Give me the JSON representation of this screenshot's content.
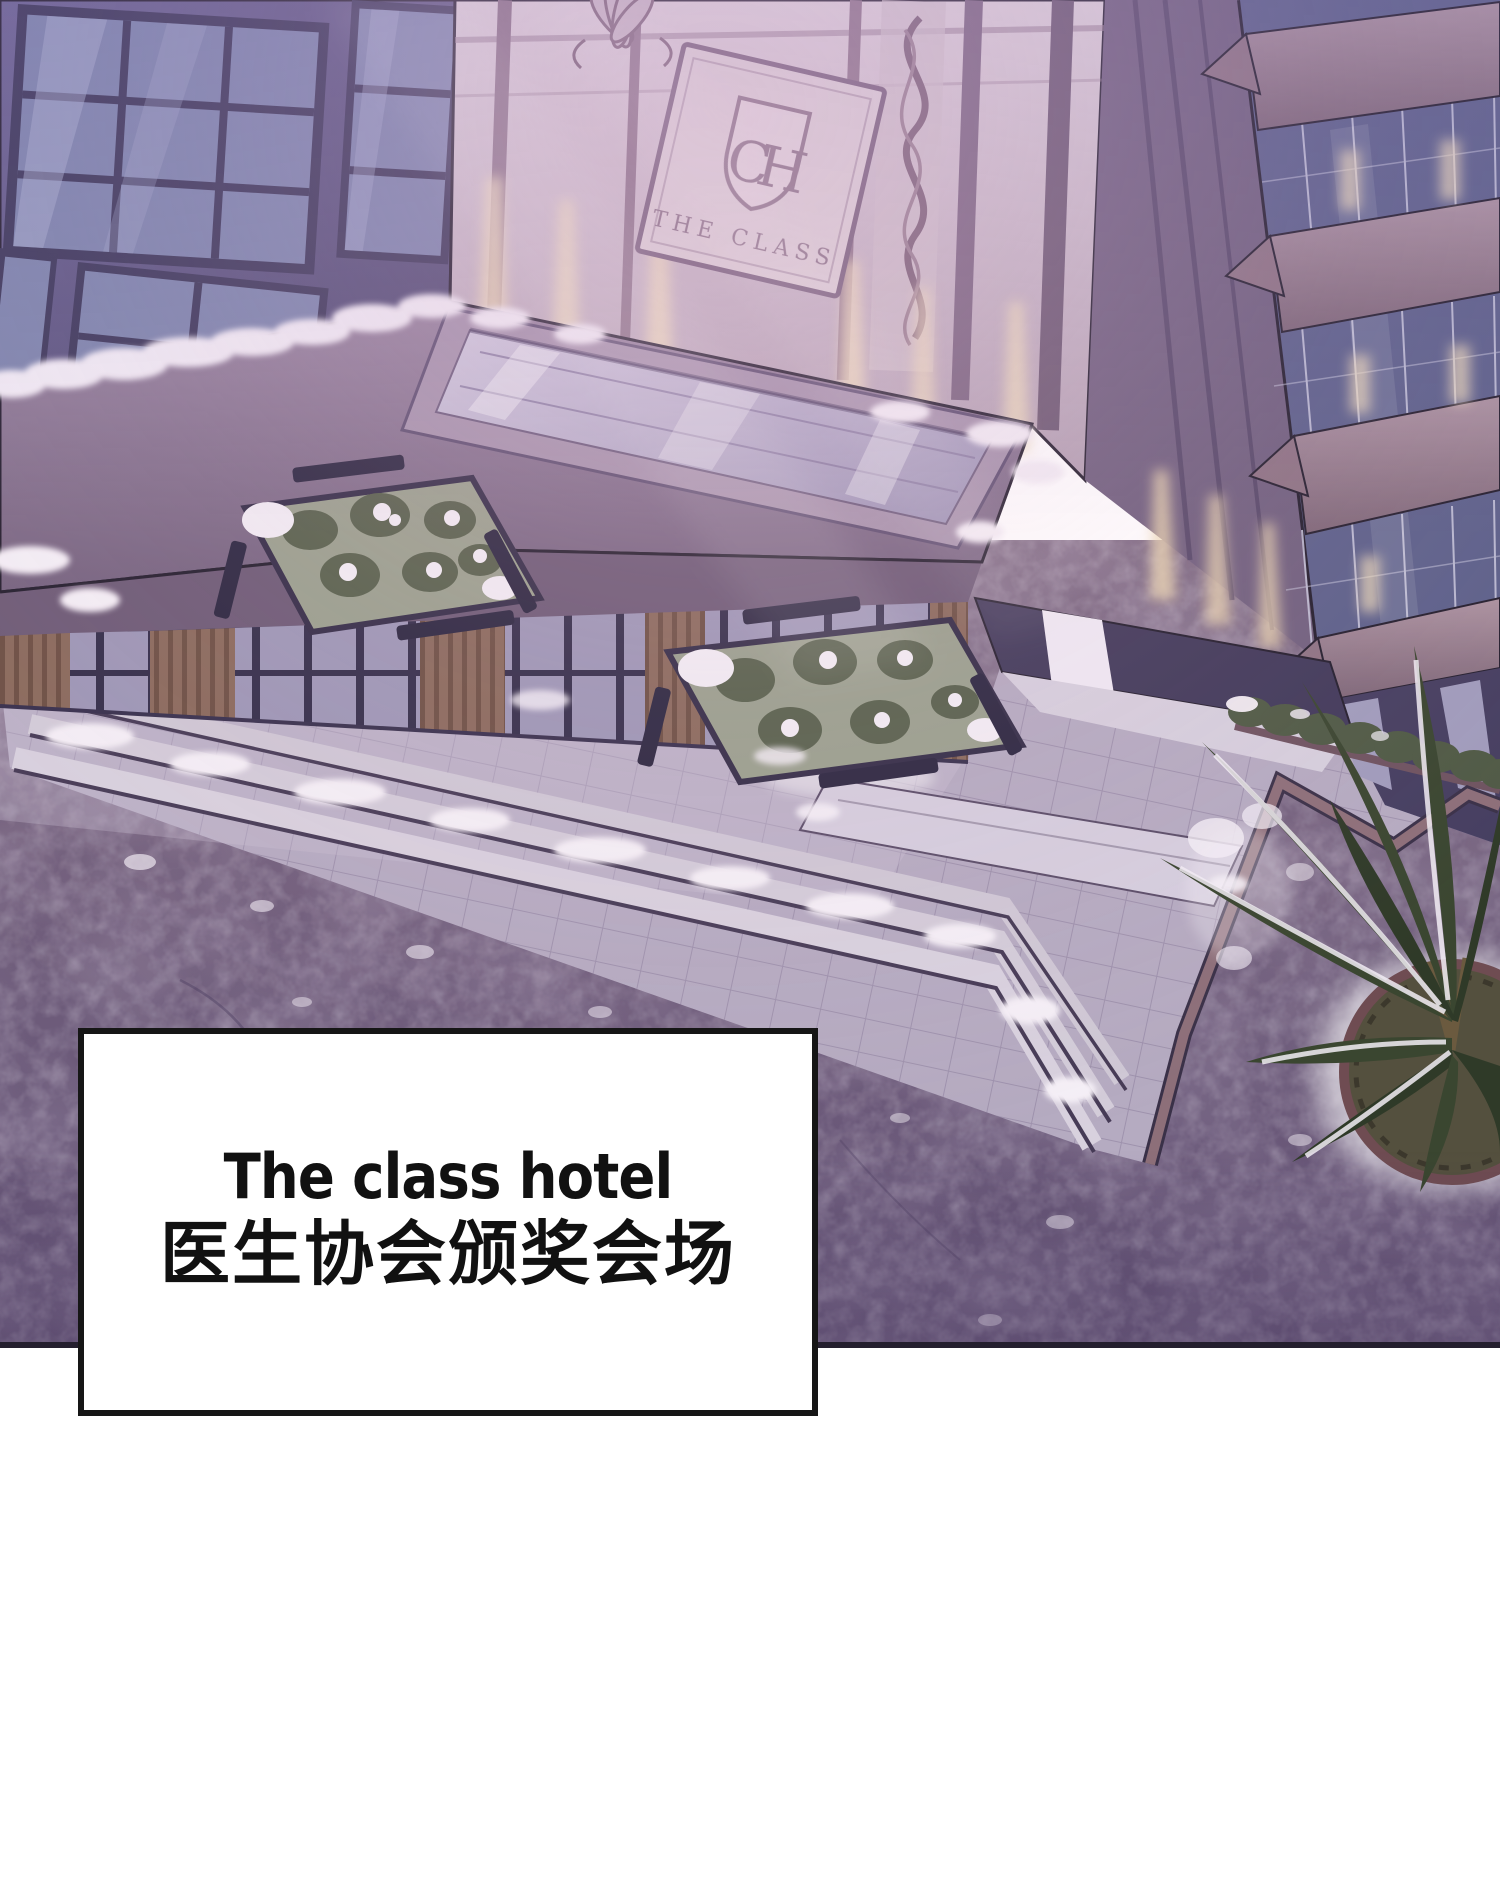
{
  "panel": {
    "kind": "webtoon-scene-panel",
    "caption": {
      "line1": "The class hotel",
      "line2": "医生协会颁奖会场"
    },
    "building_sign": {
      "monogram": "CH",
      "name": "THE CLASS"
    },
    "palette": {
      "asphalt": "#6f5d7b",
      "plaza_tile": "#b5abc1",
      "step_light": "#d6cfdd",
      "canopy_roof": "#8a7590",
      "skylight_glass": "#c3bcd3",
      "facade_cream": "#d9ccd3",
      "left_wall": "#605a7e",
      "window_glass": "#7e86ad",
      "tower_glass": "#666c99",
      "floor_band": "#a58d98",
      "wood_slat": "#8a6a5c",
      "warm_light": "#f2e0bd",
      "snow": "#f4eff6",
      "foliage": "#4f5a45",
      "tree_leaf": "#3a4630",
      "mat": "#d5cede",
      "border_edging": "#8d6f79",
      "outline": "#241f2e",
      "caption_bg": "#ffffff",
      "caption_border": "#161616",
      "caption_text": "#111111"
    }
  }
}
